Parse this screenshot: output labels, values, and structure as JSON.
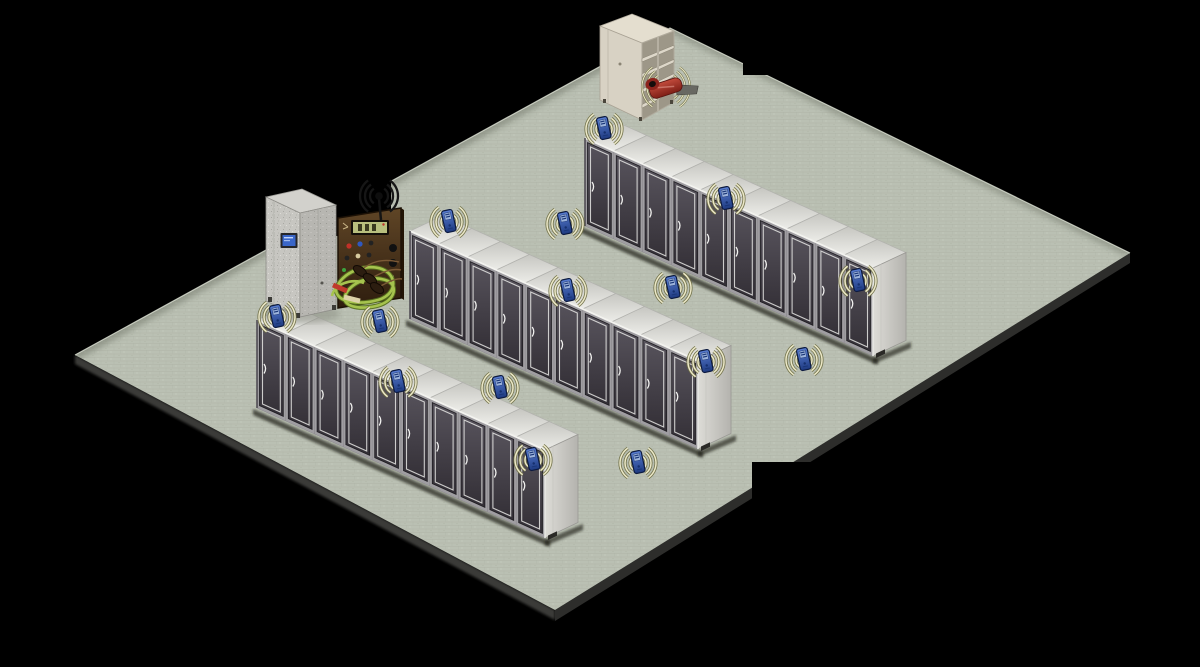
{
  "canvas": {
    "width": 1200,
    "height": 667,
    "background_color": "#000000"
  },
  "diagram": {
    "kind": "isometric-data-center-wireless-monitoring",
    "floor": {
      "corners": {
        "top": [
          670,
          28
        ],
        "right": [
          1130,
          253
        ],
        "bottom": [
          555,
          610
        ],
        "left": [
          75,
          355
        ]
      },
      "surface_color": "#bac0b3",
      "grout_color": "#a9afa2",
      "edge_slab_color": "#2d2d2b"
    },
    "rack_rows": [
      {
        "name": "rack-row-back",
        "origin": [
          585,
          138
        ],
        "cabinets": 10
      },
      {
        "name": "rack-row-middle",
        "origin": [
          410,
          231
        ],
        "cabinets": 10
      },
      {
        "name": "rack-row-front",
        "origin": [
          257,
          320
        ],
        "cabinets": 10
      }
    ],
    "rack_colors": {
      "door_dark": "#37343b",
      "door_light": "#57535c",
      "frame": "#a09ea2",
      "top_face": "#d6d6d1",
      "end_panel": "#cbcac5",
      "trim": "#e6e6e4"
    },
    "wireless_sensors": [
      {
        "x": 604,
        "y": 129
      },
      {
        "x": 726,
        "y": 199
      },
      {
        "x": 858,
        "y": 281
      },
      {
        "x": 565,
        "y": 224
      },
      {
        "x": 449,
        "y": 222
      },
      {
        "x": 568,
        "y": 291
      },
      {
        "x": 673,
        "y": 288
      },
      {
        "x": 706,
        "y": 362
      },
      {
        "x": 804,
        "y": 360
      },
      {
        "x": 277,
        "y": 317
      },
      {
        "x": 380,
        "y": 322
      },
      {
        "x": 398,
        "y": 382
      },
      {
        "x": 500,
        "y": 388
      },
      {
        "x": 533,
        "y": 460
      },
      {
        "x": 638,
        "y": 463
      }
    ],
    "sensor_colors": {
      "body": "#2e4f9e",
      "screen": "#9db4dc",
      "arc_core": "#ece8c8",
      "arc_edge": "#6e6e44"
    },
    "wireless_clamp_sensor": {
      "x": 666,
      "y": 87,
      "body_color": "#9e2b20",
      "jaw_color": "#686862"
    },
    "storage_cabinet": {
      "x": 598,
      "y": 13,
      "shelves": 4,
      "color": "#d8d2c4"
    },
    "power_enclosure": {
      "x": 266,
      "y": 189,
      "screen_color": "#3a66c8",
      "body_color": "#c7c6c1"
    },
    "gateway_panel": {
      "x": 338,
      "y": 196,
      "body_color": "#4a3218",
      "antenna_tip": [
        379,
        196
      ],
      "display_color": "#b8bf7e",
      "ct_cable_color": "#a6c34e"
    },
    "redacted_labels": [
      {
        "x": 23,
        "y": 118,
        "w": 277,
        "h": 37
      },
      {
        "x": 743,
        "y": 18,
        "w": 360,
        "h": 57
      },
      {
        "x": 248,
        "y": 178,
        "w": 143,
        "h": 58
      },
      {
        "x": 752,
        "y": 462,
        "w": 318,
        "h": 58
      },
      {
        "x": 308,
        "y": 624,
        "w": 808,
        "h": 30
      },
      {
        "x": 1126,
        "y": 624,
        "w": 16,
        "h": 29
      }
    ]
  }
}
